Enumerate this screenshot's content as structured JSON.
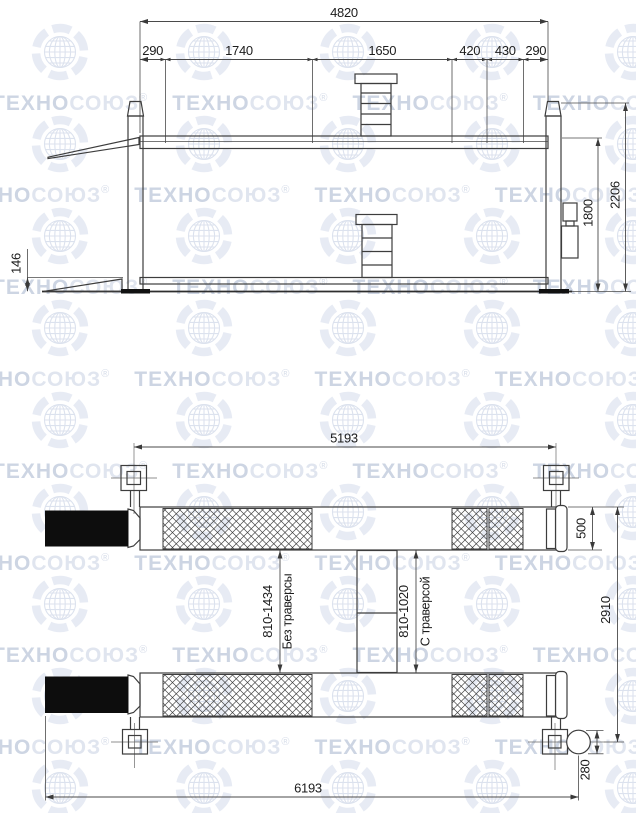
{
  "watermark": {
    "brand_part1": "ТЕХНО",
    "brand_part2": "СОЮЗ",
    "registered": "®"
  },
  "side_view": {
    "dims": {
      "total_width": "4820",
      "segments": [
        "290",
        "1740",
        "1650",
        "420",
        "430",
        "290"
      ],
      "ramp_height": "146",
      "platform_height": "1800",
      "post_height": "2206"
    }
  },
  "plan_view": {
    "dims": {
      "post_span": "5193",
      "total_length": "6193",
      "runway_width": "500",
      "overall_width": "2910",
      "motor_diameter": "280",
      "without_traverse_range": "810-1434",
      "without_traverse_label": "Без траверсы",
      "with_traverse_range": "810-1020",
      "with_traverse_label": "С траверсой"
    }
  }
}
